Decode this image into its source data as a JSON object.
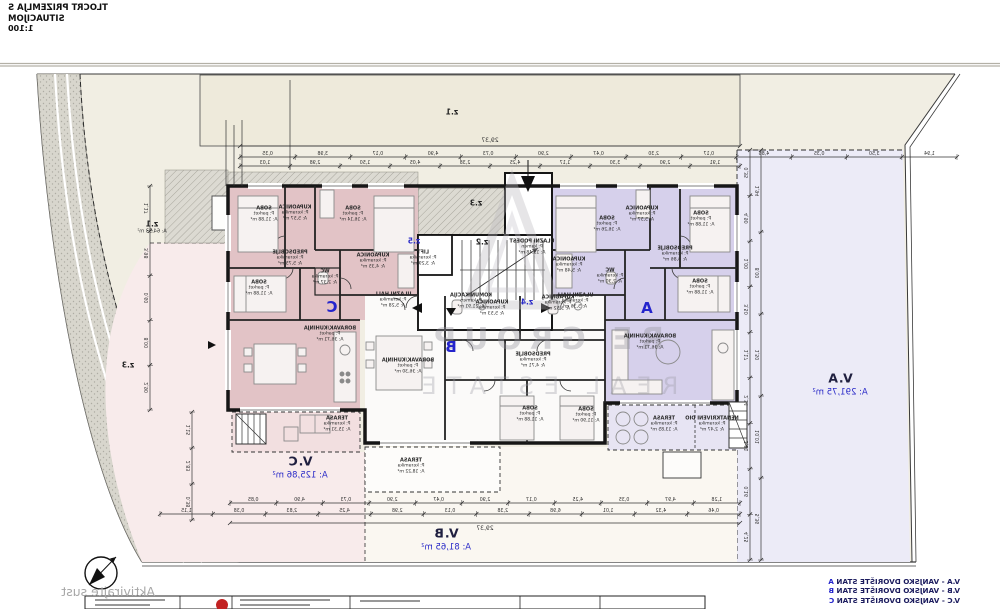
{
  "title": {
    "line1": "TLOCRT PRIZEMLJA S SITUACIJOM",
    "scale": "1:100"
  },
  "legend": {
    "items": [
      {
        "text": "V.A - VANJSKO DVORIŠTE STAN ",
        "letter": "A"
      },
      {
        "text": "V.B - VANJSKO DVORIŠTE STAN ",
        "letter": "B"
      },
      {
        "text": "V.C - VANJSKO DVORIŠTE STAN ",
        "letter": "C"
      }
    ]
  },
  "watermark": {
    "line1": "RE GROUP",
    "line2": "REAL ESTATE",
    "os_activate": "Aktivirajte sust"
  },
  "zones": [
    {
      "id": "z1_top",
      "label": "z.1",
      "area": ""
    },
    {
      "id": "z1_left",
      "label": "z.1",
      "area": "A: 64,33 m²"
    },
    {
      "id": "z2",
      "label": "z.2",
      "area": ""
    },
    {
      "id": "z3_left",
      "label": "z.3",
      "area": ""
    },
    {
      "id": "z3_mid",
      "label": "z.3",
      "area": ""
    },
    {
      "id": "z4",
      "label": "z.4",
      "area": ""
    },
    {
      "id": "z5",
      "label": "z.5",
      "area": ""
    }
  ],
  "core": {
    "podest": {
      "name": "ULAZNI PODEST",
      "floor": "P: kamen",
      "area": "A: 13,48 m²"
    },
    "komunikacija": {
      "name": "KOMUNIKACIJA",
      "floor": "P: kamen",
      "area": "A: 21,91 m²"
    },
    "lift": {
      "name": "LIFT",
      "floor": "P: keramika",
      "area": "A: 3,29 m²"
    }
  },
  "apartments": {
    "C": {
      "letter": "C",
      "rooms": [
        {
          "name": "SOBA",
          "floor": "P: parket",
          "area": "A: 11,88 m²"
        },
        {
          "name": "KUPAONICA",
          "floor": "P: keramika",
          "area": "A: 5,57 m²"
        },
        {
          "name": "SOBA",
          "floor": "P: parket",
          "area": "A: 16,14 m²"
        },
        {
          "name": "PREDSOBLJE",
          "floor": "P: keramika",
          "area": "A: 5,75 m²"
        },
        {
          "name": "WC",
          "floor": "P: keramika",
          "area": "A: 2,37 m²"
        },
        {
          "name": "KUPAONICA",
          "floor": "P: keramika",
          "area": "A: 4,35 m²"
        },
        {
          "name": "SOBA",
          "floor": "P: parket",
          "area": "A: 11,88 m²"
        },
        {
          "name": "ULAZNI HALL",
          "floor": "P: keramika",
          "area": "A: 5,28 m²"
        },
        {
          "name": "BORAVAK/KUHINJA",
          "floor": "P: parket",
          "area": "A: 36,71 m²"
        },
        {
          "name": "TERASA",
          "floor": "P: keramika",
          "area": "A: 15,31 m²"
        }
      ]
    },
    "B": {
      "letter": "B",
      "rooms": [
        {
          "name": "BORAVAK/KUHINJA",
          "floor": "P: parket",
          "area": "A: 36,30 m²"
        },
        {
          "name": "KUPAONICA",
          "floor": "P: keramika",
          "area": "A: 5,53 m²"
        },
        {
          "name": "KUPAONICA",
          "floor": "P: keramika",
          "area": "A: 5,52 m²"
        },
        {
          "name": "PREDSOBLJE",
          "floor": "P: keramika",
          "area": "A: 4,71 m²"
        },
        {
          "name": "SOBA",
          "floor": "P: parket",
          "area": "A: 11,88 m²"
        },
        {
          "name": "SOBA",
          "floor": "P: parket",
          "area": "A: 11,90 m²"
        },
        {
          "name": "TERASA",
          "floor": "P: keramika",
          "area": "A: 18,22 m²"
        }
      ]
    },
    "A": {
      "letter": "A",
      "rooms": [
        {
          "name": "SOBA",
          "floor": "P: parket",
          "area": "A: 16,26 m²"
        },
        {
          "name": "KUPAONICA",
          "floor": "P: keramika",
          "area": "A: 5,57 m²"
        },
        {
          "name": "SOBA",
          "floor": "P: parket",
          "area": "A: 11,88 m²"
        },
        {
          "name": "KUPAONICA",
          "floor": "P: keramika",
          "area": "A: 5,48 m²"
        },
        {
          "name": "PREDSOBLJE",
          "floor": "P: keramika",
          "area": "A: 6,86 m²"
        },
        {
          "name": "WC",
          "floor": "P: keramika",
          "area": "A: 2,30 m²"
        },
        {
          "name": "ULAZNI HALL",
          "floor": "P: keramika",
          "area": "A: 5,36 m²"
        },
        {
          "name": "SOBA",
          "floor": "P: parket",
          "area": "A: 11,88 m²"
        },
        {
          "name": "BORAVAK/KUHINJA",
          "floor": "P: parket",
          "area": "A: 36,71 m²"
        },
        {
          "name": "TERASA",
          "floor": "P: keramika",
          "area": "A: 13,85 m²"
        },
        {
          "name": "NENATKRIVENI DIO",
          "floor": "P: keramika",
          "area": "A: 2,47 m²"
        }
      ]
    }
  },
  "yards": [
    {
      "id": "VC",
      "label": "V.C",
      "area": "A: 125,86 m²"
    },
    {
      "id": "VB",
      "label": "V.B",
      "area": "A: 81,65 m²"
    },
    {
      "id": "VA",
      "label": "V.A",
      "area": "A: 291,75 m²"
    }
  ],
  "dimensions": {
    "total_top": "29,37",
    "total_bottom": "29,37",
    "top_chain": [
      "0,35",
      "3,98",
      "0,17",
      "4,90",
      "0,73",
      "2,90",
      "0,47",
      "2,30",
      "0,17",
      "4,86",
      "0,35",
      "3,50",
      "1,94"
    ],
    "top_chain2": [
      "1,03",
      "2,98",
      "1,50",
      "4,05",
      "2,38",
      "4,25",
      "1,17",
      "3,30",
      "2,90",
      "1,91"
    ],
    "bottom_chain": [
      "0,85",
      "4,90",
      "0,73",
      "2,90",
      "0,47",
      "2,90",
      "0,17",
      "4,25",
      "0,35",
      "4,97",
      "1,28"
    ],
    "bottom_chain2": [
      "1,15",
      "0,38",
      "2,83",
      "4,25",
      "2,98",
      "0,13",
      "2,38",
      "6,98",
      "1,01",
      "4,32",
      "0,46"
    ],
    "right_chain": [
      "0,35",
      "4,90",
      "1,00",
      "3,50",
      "1,17",
      "2,34",
      "3,81",
      "0,16",
      "4,25"
    ],
    "right_chain2": [
      "1,94",
      "8,00",
      "1,50",
      "10,01",
      "5,36"
    ],
    "left_chain": [
      "1,17",
      "3,98",
      "0,60",
      "8,00",
      "2,90"
    ],
    "left_chain2": [
      "1,15",
      "2,83",
      "0,38"
    ]
  },
  "colors": {
    "accent_blue": "#2b2bc8",
    "wall": "#161616",
    "pink_room": "#e2c3c6",
    "pink_yard": "#f8ebeb",
    "lavender_room": "#d6d0eb",
    "lavender_yard": "#ecebf7",
    "cream": "#f1eee3",
    "parcel": "#eeeadb",
    "road_gray": "#d8d6cd",
    "logo_red": "#c22222"
  }
}
